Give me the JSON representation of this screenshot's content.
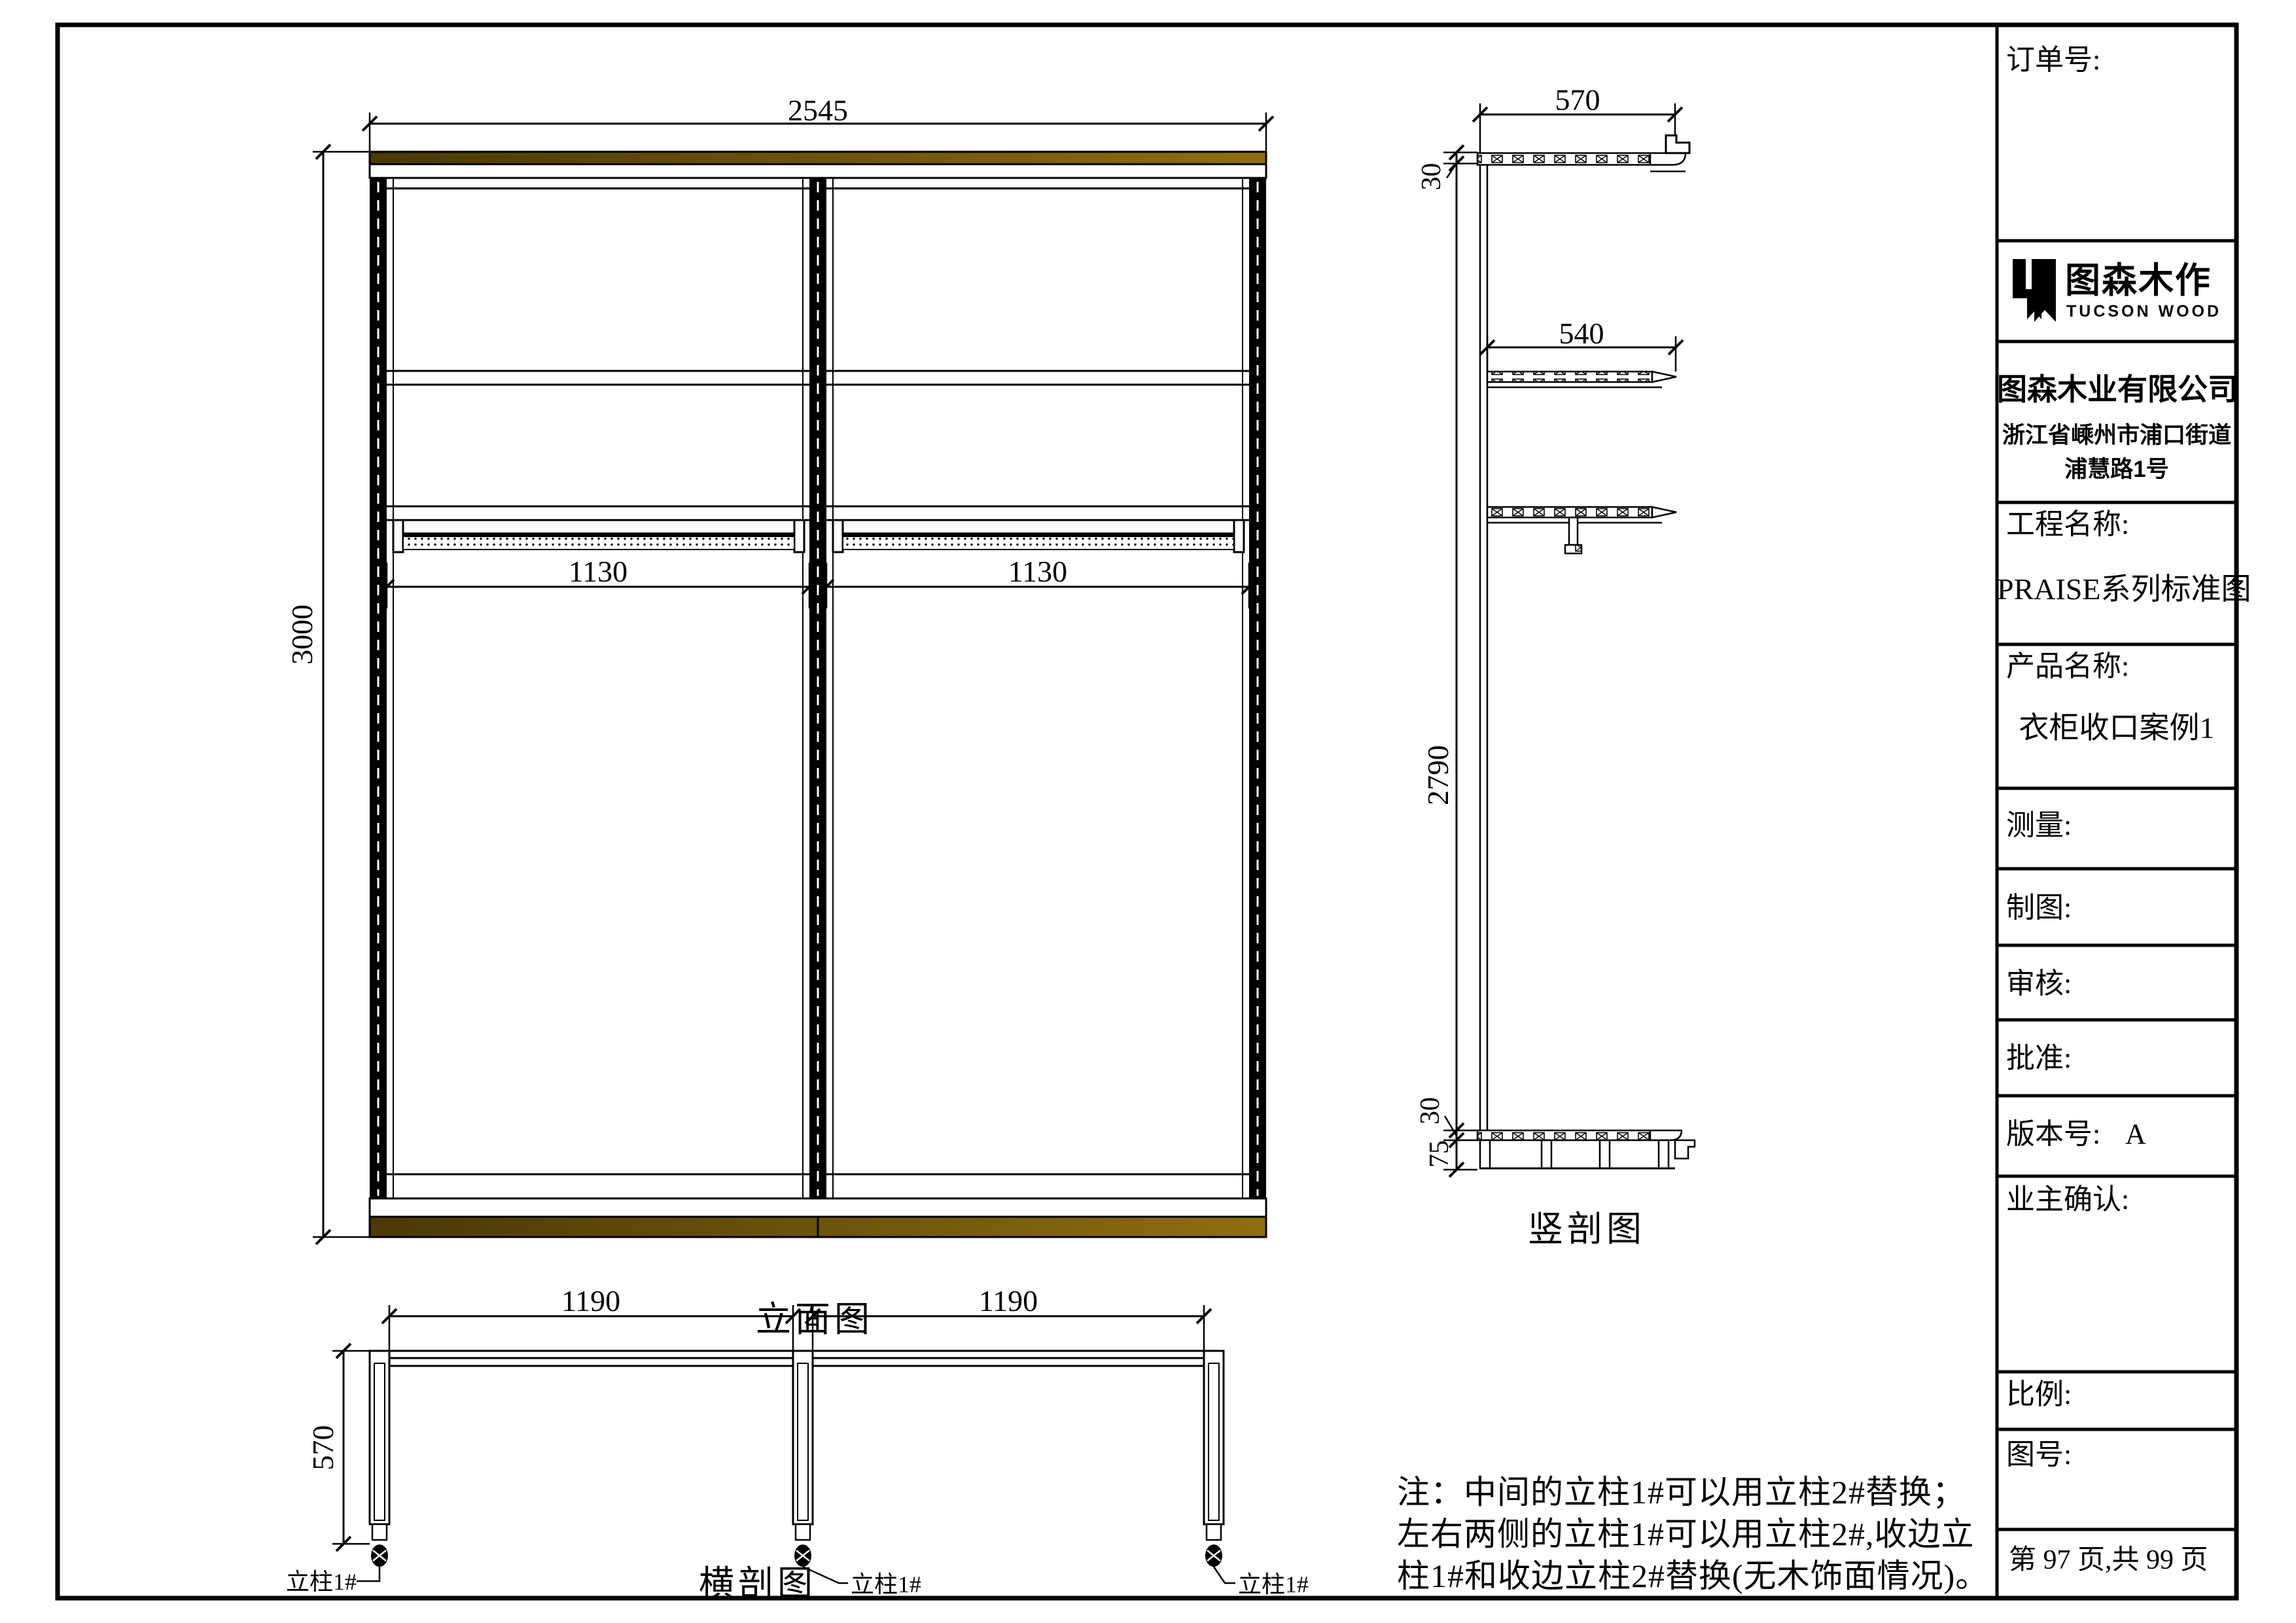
{
  "title_block": {
    "order_label": "订单号:",
    "logo": {
      "cn": "图森木作",
      "en": "TUCSON WOOD"
    },
    "company": {
      "name": "图森木业有限公司",
      "address_line1": "浙江省嵊州市浦口街道",
      "address_line2": "浦慧路1号"
    },
    "project": {
      "label": "工程名称:",
      "value": "PRAISE系列标准图"
    },
    "product": {
      "label": "产品名称:",
      "value": "衣柜收口案例1"
    },
    "measure_label": "测量:",
    "draft_label": "制图:",
    "review_label": "审核:",
    "approve_label": "批准:",
    "version": {
      "label": "版本号:",
      "value": "A"
    },
    "owner_label": "业主确认:",
    "scale_label": "比例:",
    "drawing_no_label": "图号:",
    "page_info": "第 97 页,共 99 页"
  },
  "views": {
    "elevation": {
      "title": "立面图",
      "dims": {
        "width": "2545",
        "height": "3000",
        "bay_left": "1130",
        "bay_right": "1130"
      }
    },
    "vertical_section": {
      "title": "竖剖图",
      "dims": {
        "depth": "570",
        "shelf_depth": "540",
        "height": "2790",
        "top_thickness": "30",
        "bottom_thickness": "30",
        "base_height": "75"
      }
    },
    "horizontal_section": {
      "title": "横剖图",
      "dims": {
        "bay_left": "1190",
        "bay_right": "1190",
        "depth": "570"
      },
      "column_label_left": "立柱1#",
      "column_label_center": "立柱1#",
      "column_label_right": "立柱1#"
    }
  },
  "note": {
    "line1": "注：中间的立柱1#可以用立柱2#替换；",
    "line2": "左右两侧的立柱1#可以用立柱2#,收边立",
    "line3": "柱1#和收边立柱2#替换(无木饰面情况)。"
  },
  "colors": {
    "line": "#000000",
    "wood_dark": "#4a3906",
    "wood_light": "#8f6e10"
  }
}
